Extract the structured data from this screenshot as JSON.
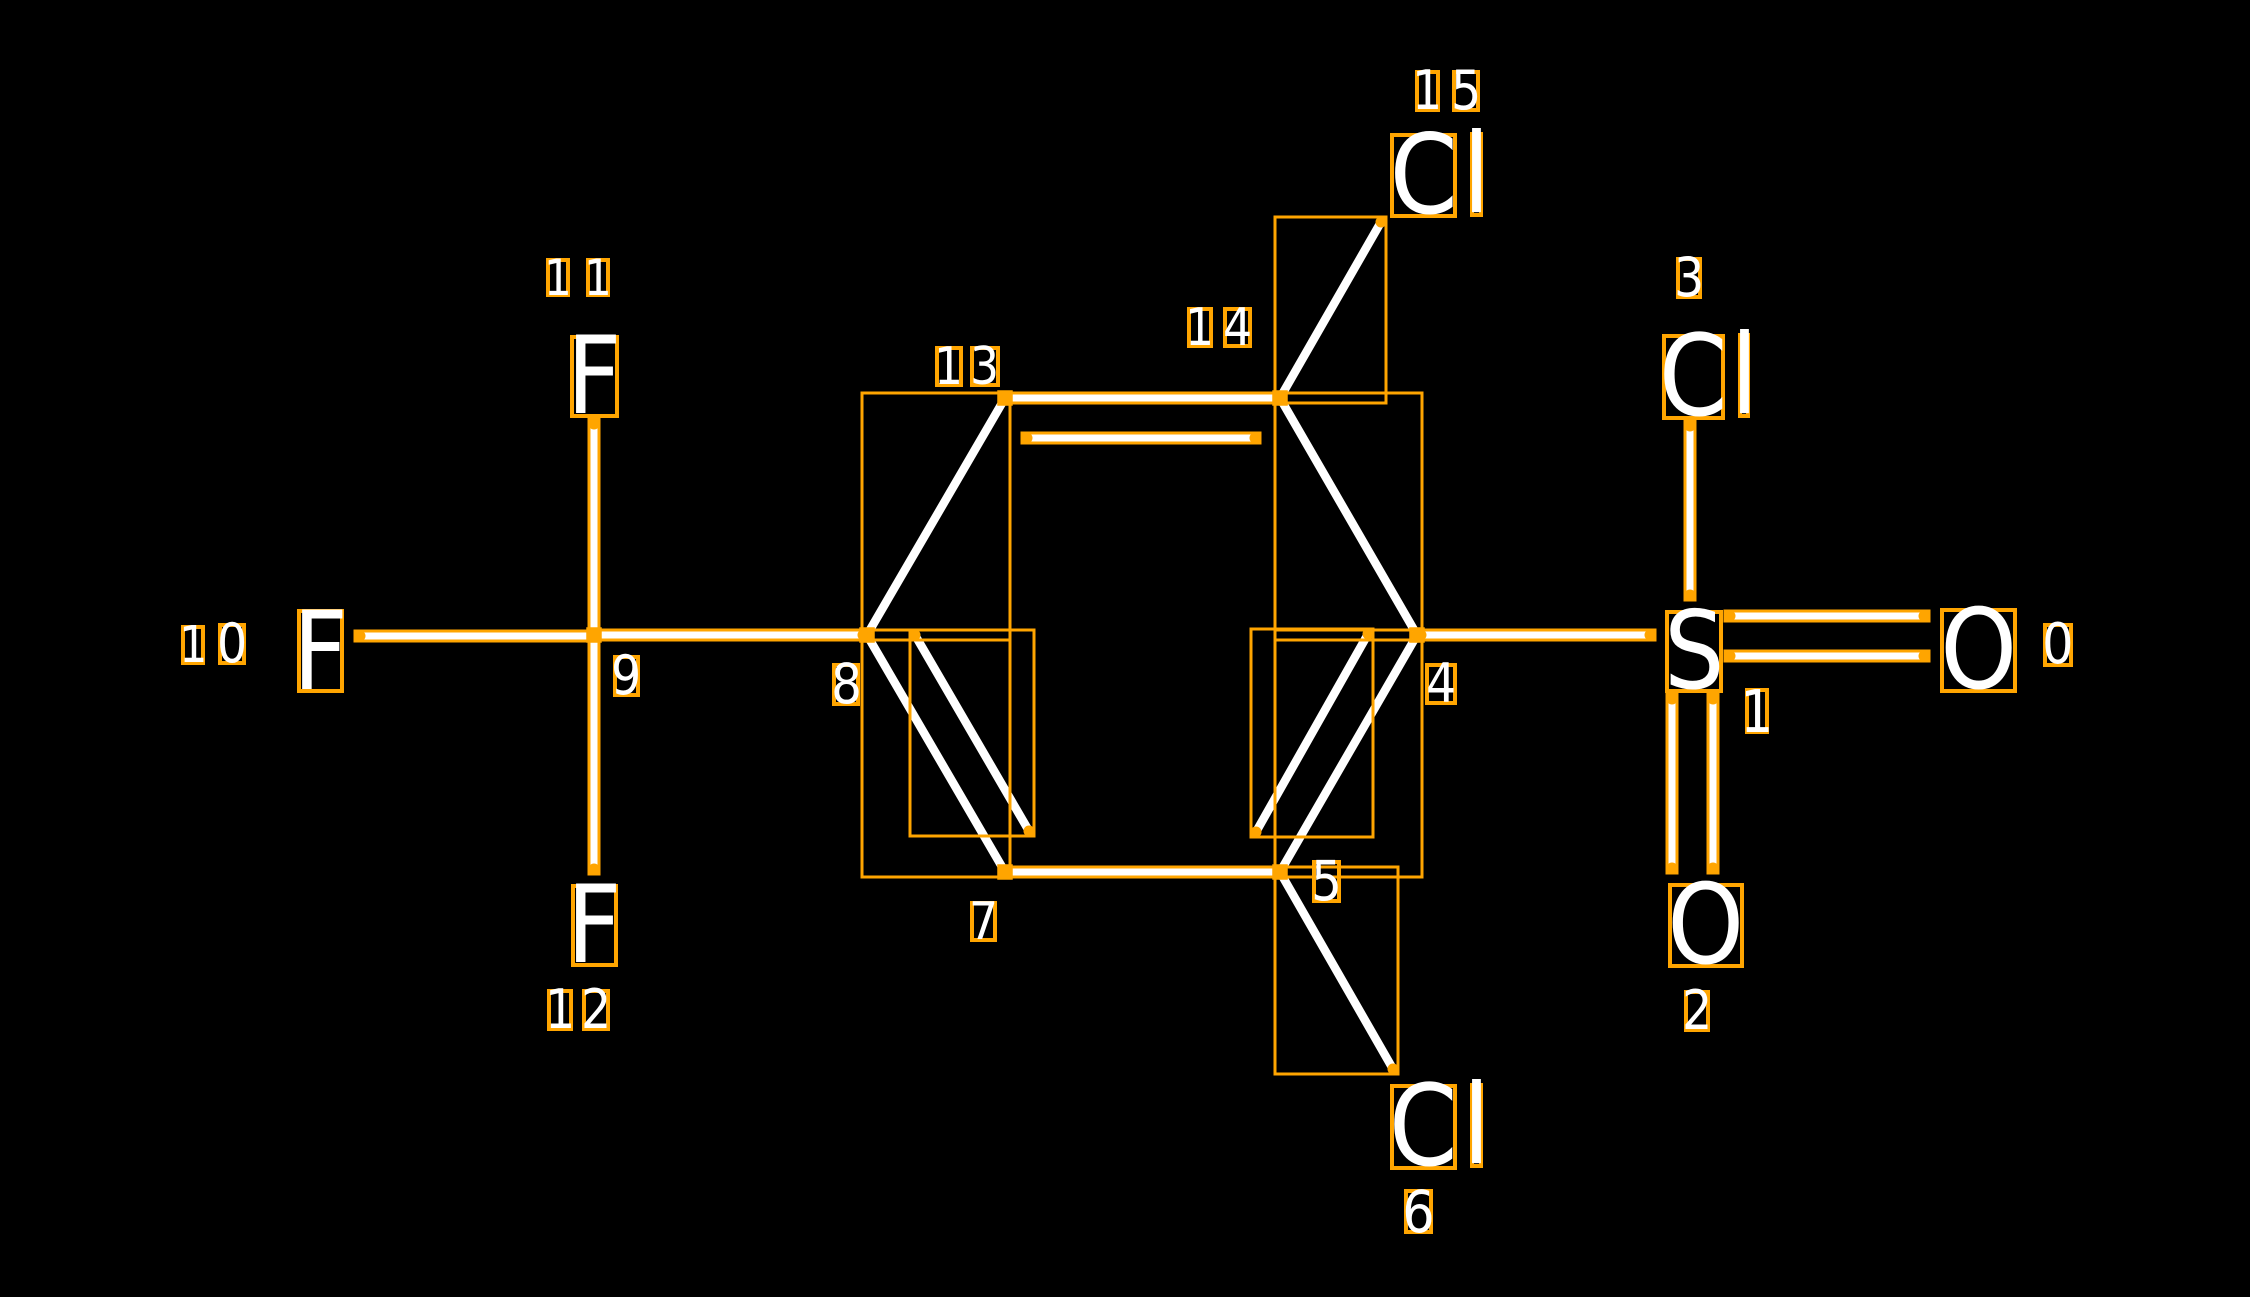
{
  "canvas": {
    "width": 2250,
    "height": 1297,
    "background": "#000000"
  },
  "colors": {
    "annotation_box": "#FFA500",
    "bond_line": "#FFFFFF",
    "atom_text": "#FFFFFF",
    "index_text": "#FFFFFF"
  },
  "molecule": {
    "atoms": [
      {
        "id": 0,
        "symbol": "O",
        "label_chars": [
          {
            "ch": "O",
            "x": 1940,
            "y": 608,
            "w": 77,
            "h": 85
          }
        ],
        "index_chars": [
          {
            "ch": "0",
            "x": 2043,
            "y": 623,
            "w": 30,
            "h": 44
          }
        ]
      },
      {
        "id": 1,
        "symbol": "S",
        "label_chars": [
          {
            "ch": "S",
            "x": 1665,
            "y": 610,
            "w": 58,
            "h": 83
          }
        ],
        "index_chars": [
          {
            "ch": "1",
            "x": 1745,
            "y": 688,
            "w": 24,
            "h": 46
          }
        ]
      },
      {
        "id": 2,
        "symbol": "O",
        "label_chars": [
          {
            "ch": "O",
            "x": 1668,
            "y": 883,
            "w": 76,
            "h": 85
          }
        ],
        "index_chars": [
          {
            "ch": "2",
            "x": 1684,
            "y": 990,
            "w": 26,
            "h": 42
          }
        ]
      },
      {
        "id": 3,
        "symbol": "Cl",
        "label_chars": [
          {
            "ch": "C",
            "x": 1662,
            "y": 334,
            "w": 63,
            "h": 86
          },
          {
            "ch": "l",
            "x": 1738,
            "y": 333,
            "w": 12,
            "h": 85
          }
        ],
        "index_chars": [
          {
            "ch": "3",
            "x": 1676,
            "y": 257,
            "w": 26,
            "h": 42
          }
        ]
      },
      {
        "id": 4,
        "symbol": "C",
        "label_chars": [],
        "index_chars": [
          {
            "ch": "4",
            "x": 1425,
            "y": 663,
            "w": 32,
            "h": 42
          }
        ]
      },
      {
        "id": 5,
        "symbol": "C",
        "label_chars": [],
        "index_chars": [
          {
            "ch": "5",
            "x": 1312,
            "y": 860,
            "w": 29,
            "h": 43
          }
        ]
      },
      {
        "id": 6,
        "symbol": "Cl",
        "label_chars": [
          {
            "ch": "C",
            "x": 1390,
            "y": 1084,
            "w": 67,
            "h": 86
          },
          {
            "ch": "l",
            "x": 1470,
            "y": 1083,
            "w": 13,
            "h": 85
          }
        ],
        "index_chars": [
          {
            "ch": "6",
            "x": 1404,
            "y": 1189,
            "w": 29,
            "h": 45
          }
        ]
      },
      {
        "id": 7,
        "symbol": "C",
        "label_chars": [],
        "index_chars": [
          {
            "ch": "7",
            "x": 970,
            "y": 901,
            "w": 27,
            "h": 41
          }
        ]
      },
      {
        "id": 8,
        "symbol": "C",
        "label_chars": [],
        "index_chars": [
          {
            "ch": "8",
            "x": 832,
            "y": 663,
            "w": 28,
            "h": 43
          }
        ]
      },
      {
        "id": 9,
        "symbol": "C",
        "label_chars": [],
        "index_chars": [
          {
            "ch": "9",
            "x": 613,
            "y": 655,
            "w": 27,
            "h": 42
          }
        ]
      },
      {
        "id": 10,
        "symbol": "F",
        "label_chars": [
          {
            "ch": "F",
            "x": 297,
            "y": 609,
            "w": 47,
            "h": 84
          }
        ],
        "index_chars": [
          {
            "ch": "1",
            "x": 181,
            "y": 625,
            "w": 24,
            "h": 40
          },
          {
            "ch": "0",
            "x": 218,
            "y": 623,
            "w": 28,
            "h": 42
          }
        ]
      },
      {
        "id": 11,
        "symbol": "F",
        "label_chars": [
          {
            "ch": "F",
            "x": 570,
            "y": 335,
            "w": 49,
            "h": 83
          }
        ],
        "index_chars": [
          {
            "ch": "1",
            "x": 546,
            "y": 258,
            "w": 24,
            "h": 39
          },
          {
            "ch": "1",
            "x": 586,
            "y": 258,
            "w": 24,
            "h": 39
          }
        ]
      },
      {
        "id": 12,
        "symbol": "F",
        "label_chars": [
          {
            "ch": "F",
            "x": 571,
            "y": 884,
            "w": 47,
            "h": 83
          }
        ],
        "index_chars": [
          {
            "ch": "1",
            "x": 547,
            "y": 989,
            "w": 26,
            "h": 42
          },
          {
            "ch": "2",
            "x": 582,
            "y": 989,
            "w": 28,
            "h": 42
          }
        ]
      },
      {
        "id": 13,
        "symbol": "C",
        "label_chars": [],
        "index_chars": [
          {
            "ch": "1",
            "x": 935,
            "y": 346,
            "w": 28,
            "h": 41
          },
          {
            "ch": "3",
            "x": 970,
            "y": 346,
            "w": 30,
            "h": 41
          }
        ]
      },
      {
        "id": 14,
        "symbol": "C",
        "label_chars": [],
        "index_chars": [
          {
            "ch": "1",
            "x": 1187,
            "y": 307,
            "w": 26,
            "h": 41
          },
          {
            "ch": "4",
            "x": 1223,
            "y": 307,
            "w": 29,
            "h": 41
          }
        ]
      },
      {
        "id": 15,
        "symbol": "Cl",
        "label_chars": [
          {
            "ch": "C",
            "x": 1390,
            "y": 133,
            "w": 67,
            "h": 85
          },
          {
            "ch": "l",
            "x": 1470,
            "y": 132,
            "w": 13,
            "h": 85
          }
        ],
        "index_chars": [
          {
            "ch": "1",
            "x": 1415,
            "y": 70,
            "w": 25,
            "h": 42
          },
          {
            "ch": "5",
            "x": 1452,
            "y": 70,
            "w": 28,
            "h": 42
          }
        ]
      }
    ],
    "bonds": [
      {
        "from": 1,
        "to": 0,
        "kind": "double-line-1",
        "x1": 1730,
        "y1": 616,
        "x2": 1924,
        "y2": 616
      },
      {
        "from": 1,
        "to": 0,
        "kind": "double-line-2",
        "x1": 1730,
        "y1": 656,
        "x2": 1924,
        "y2": 656
      },
      {
        "from": 1,
        "to": 2,
        "kind": "double-line-1",
        "x1": 1672,
        "y1": 699,
        "x2": 1672,
        "y2": 868
      },
      {
        "from": 1,
        "to": 2,
        "kind": "double-line-2",
        "x1": 1713,
        "y1": 699,
        "x2": 1713,
        "y2": 868
      },
      {
        "from": 3,
        "to": 1,
        "kind": "single",
        "x1": 1690,
        "y1": 426,
        "x2": 1690,
        "y2": 595
      },
      {
        "from": 4,
        "to": 1,
        "kind": "single",
        "x1": 1421,
        "y1": 635,
        "x2": 1650,
        "y2": 635
      },
      {
        "from": 14,
        "to": 4,
        "kind": "single",
        "x1": 1280,
        "y1": 398,
        "x2": 1417,
        "y2": 635
      },
      {
        "from": 4,
        "to": 5,
        "kind": "single",
        "x1": 1417,
        "y1": 635,
        "x2": 1280,
        "y2": 872
      },
      {
        "from": 4,
        "to": 5,
        "kind": "inner-double",
        "x1": 1368,
        "y1": 634,
        "x2": 1256,
        "y2": 832
      },
      {
        "from": 13,
        "to": 14,
        "kind": "single",
        "x1": 1005,
        "y1": 398,
        "x2": 1280,
        "y2": 398
      },
      {
        "from": 13,
        "to": 14,
        "kind": "inner-double",
        "x1": 1027,
        "y1": 438,
        "x2": 1255,
        "y2": 438
      },
      {
        "from": 14,
        "to": 15,
        "kind": "single",
        "x1": 1280,
        "y1": 398,
        "x2": 1381,
        "y2": 222
      },
      {
        "from": 13,
        "to": 8,
        "kind": "single",
        "x1": 1005,
        "y1": 398,
        "x2": 867,
        "y2": 635
      },
      {
        "from": 8,
        "to": 7,
        "kind": "single",
        "x1": 867,
        "y1": 635,
        "x2": 1005,
        "y2": 872
      },
      {
        "from": 8,
        "to": 7,
        "kind": "inner-double",
        "x1": 915,
        "y1": 635,
        "x2": 1029,
        "y2": 831
      },
      {
        "from": 7,
        "to": 5,
        "kind": "single",
        "x1": 1005,
        "y1": 872,
        "x2": 1280,
        "y2": 872
      },
      {
        "from": 5,
        "to": 6,
        "kind": "single",
        "x1": 1280,
        "y1": 872,
        "x2": 1393,
        "y2": 1069
      },
      {
        "from": 9,
        "to": 8,
        "kind": "single",
        "x1": 594,
        "y1": 635,
        "x2": 863,
        "y2": 635
      },
      {
        "from": 10,
        "to": 9,
        "kind": "single",
        "x1": 360,
        "y1": 636,
        "x2": 594,
        "y2": 636
      },
      {
        "from": 11,
        "to": 9,
        "kind": "single",
        "x1": 594,
        "y1": 424,
        "x2": 594,
        "y2": 635
      },
      {
        "from": 9,
        "to": 12,
        "kind": "single",
        "x1": 594,
        "y1": 635,
        "x2": 594,
        "y2": 869
      }
    ],
    "junction_markers": [
      {
        "atom": 4,
        "x": 1417,
        "y": 635
      },
      {
        "atom": 5,
        "x": 1280,
        "y": 872
      },
      {
        "atom": 7,
        "x": 1005,
        "y": 872
      },
      {
        "atom": 8,
        "x": 867,
        "y": 635
      },
      {
        "atom": 9,
        "x": 594,
        "y": 635
      },
      {
        "atom": 13,
        "x": 1005,
        "y": 398
      },
      {
        "atom": 14,
        "x": 1280,
        "y": 398
      }
    ]
  }
}
